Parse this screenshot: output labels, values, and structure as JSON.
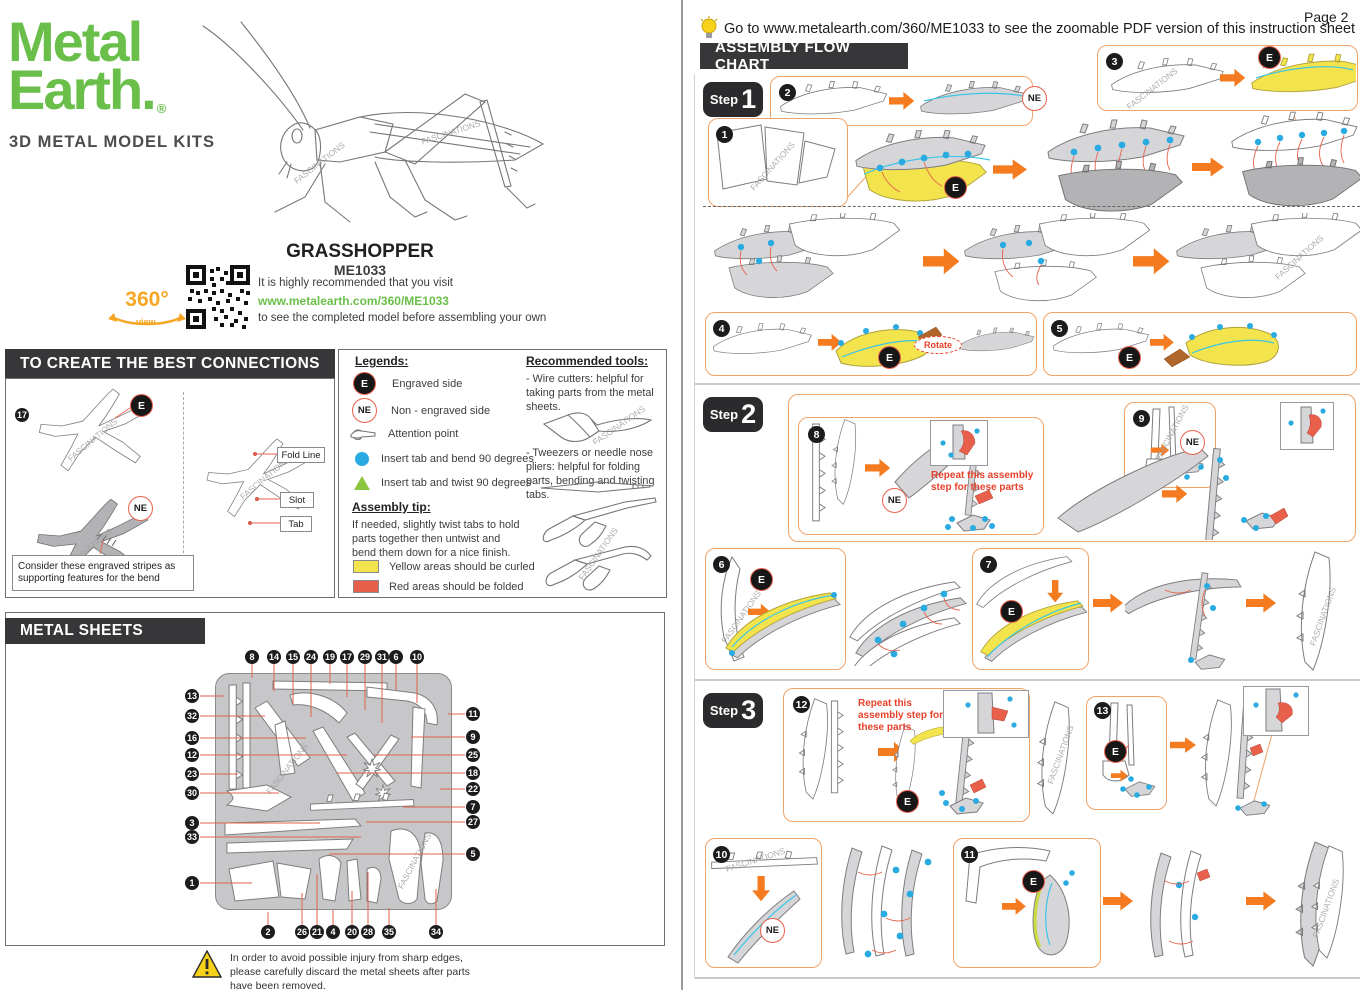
{
  "colors": {
    "brand_green": "#6abf4a",
    "accent_orange": "#f47b20",
    "box_orange": "#f0a368",
    "highlight_yellow": "#f3e44d",
    "fold_red": "#e8604c",
    "note_red": "#e8402a",
    "dot_blue": "#29abe2",
    "twist_green": "#8cc63f",
    "header_dark": "#37373a"
  },
  "brand": {
    "name_line1": "Metal",
    "name_line2": "Earth.",
    "registered": "®",
    "tagline": "3D METAL MODEL KITS"
  },
  "product": {
    "name": "GRASSHOPPER",
    "sku": "ME1033",
    "view360_label": "360°",
    "view360_sub": "view",
    "visit_line1": "It is highly recommended that you visit",
    "visit_url": "www.metalearth.com/360/ME1033",
    "visit_line2": "to see the completed model before assembling your own"
  },
  "connections": {
    "header": "TO CREATE THE BEST CONNECTIONS",
    "example_part_number": "17",
    "engraved_badge": "E",
    "non_engraved_badge": "NE",
    "note": "Consider these engraved stripes as supporting features for the bend",
    "labels": {
      "fold_line": "Fold Line",
      "slot": "Slot",
      "tab": "Tab"
    }
  },
  "legends": {
    "title": "Legends:",
    "items": [
      {
        "icon": "engraved-badge",
        "label": "Engraved side"
      },
      {
        "icon": "non-engraved-badge",
        "label": "Non - engraved side"
      },
      {
        "icon": "attention-hand",
        "label": "Attention point"
      },
      {
        "icon": "blue-dot",
        "label": "Insert tab and bend 90 degrees"
      },
      {
        "icon": "green-triangle",
        "label": "Insert tab and twist 90 degrees"
      }
    ],
    "assembly_tip_title": "Assembly tip:",
    "assembly_tip_text": "If needed, slightly twist tabs to hold parts together then untwist and bend them down for a nice finish.",
    "yellow_note": "Yellow areas should be curled",
    "red_note": "Red areas should be folded"
  },
  "tools": {
    "title": "Recommended tools:",
    "wire_cutters": "- Wire cutters: helpful for taking parts from the metal sheets.",
    "tweezers": "- Tweezers or needle nose pliers: helpful for folding parts, bending and twisting tabs."
  },
  "metal_sheets": {
    "header": "METAL SHEETS",
    "top_numbers": [
      "8",
      "14",
      "15",
      "24",
      "19",
      "17",
      "29",
      "31",
      "6",
      "10"
    ],
    "left_numbers": [
      "13",
      "32",
      "16",
      "12",
      "23",
      "30",
      "3",
      "33",
      "1"
    ],
    "right_numbers": [
      "11",
      "9",
      "25",
      "18",
      "22",
      "7",
      "27",
      "5"
    ],
    "bottom_numbers": [
      "2",
      "26",
      "21",
      "4",
      "20",
      "28",
      "35",
      "34"
    ]
  },
  "warning": {
    "text": "In order to avoid possible injury from sharp edges, please carefully discard the metal sheets after parts have been removed."
  },
  "flow": {
    "page_label": "Page 2",
    "tip": "Go to www.metalearth.com/360/ME1033 to see the zoomable PDF version of this instruction sheet",
    "header": "ASSEMBLY FLOW CHART",
    "step_word": "Step",
    "step_numbers": [
      "1",
      "2",
      "3"
    ],
    "engraved_badge": "E",
    "non_engraved_badge": "NE",
    "rotate_label": "Rotate",
    "repeat_note": "Repeat this assembly step for these parts",
    "step1_parts": [
      "1",
      "2",
      "3",
      "4",
      "5"
    ],
    "step2_parts": [
      "8",
      "9",
      "6",
      "7"
    ],
    "step3_parts": [
      "12",
      "13",
      "10",
      "11"
    ]
  },
  "watermark": "FASCINATIONS"
}
